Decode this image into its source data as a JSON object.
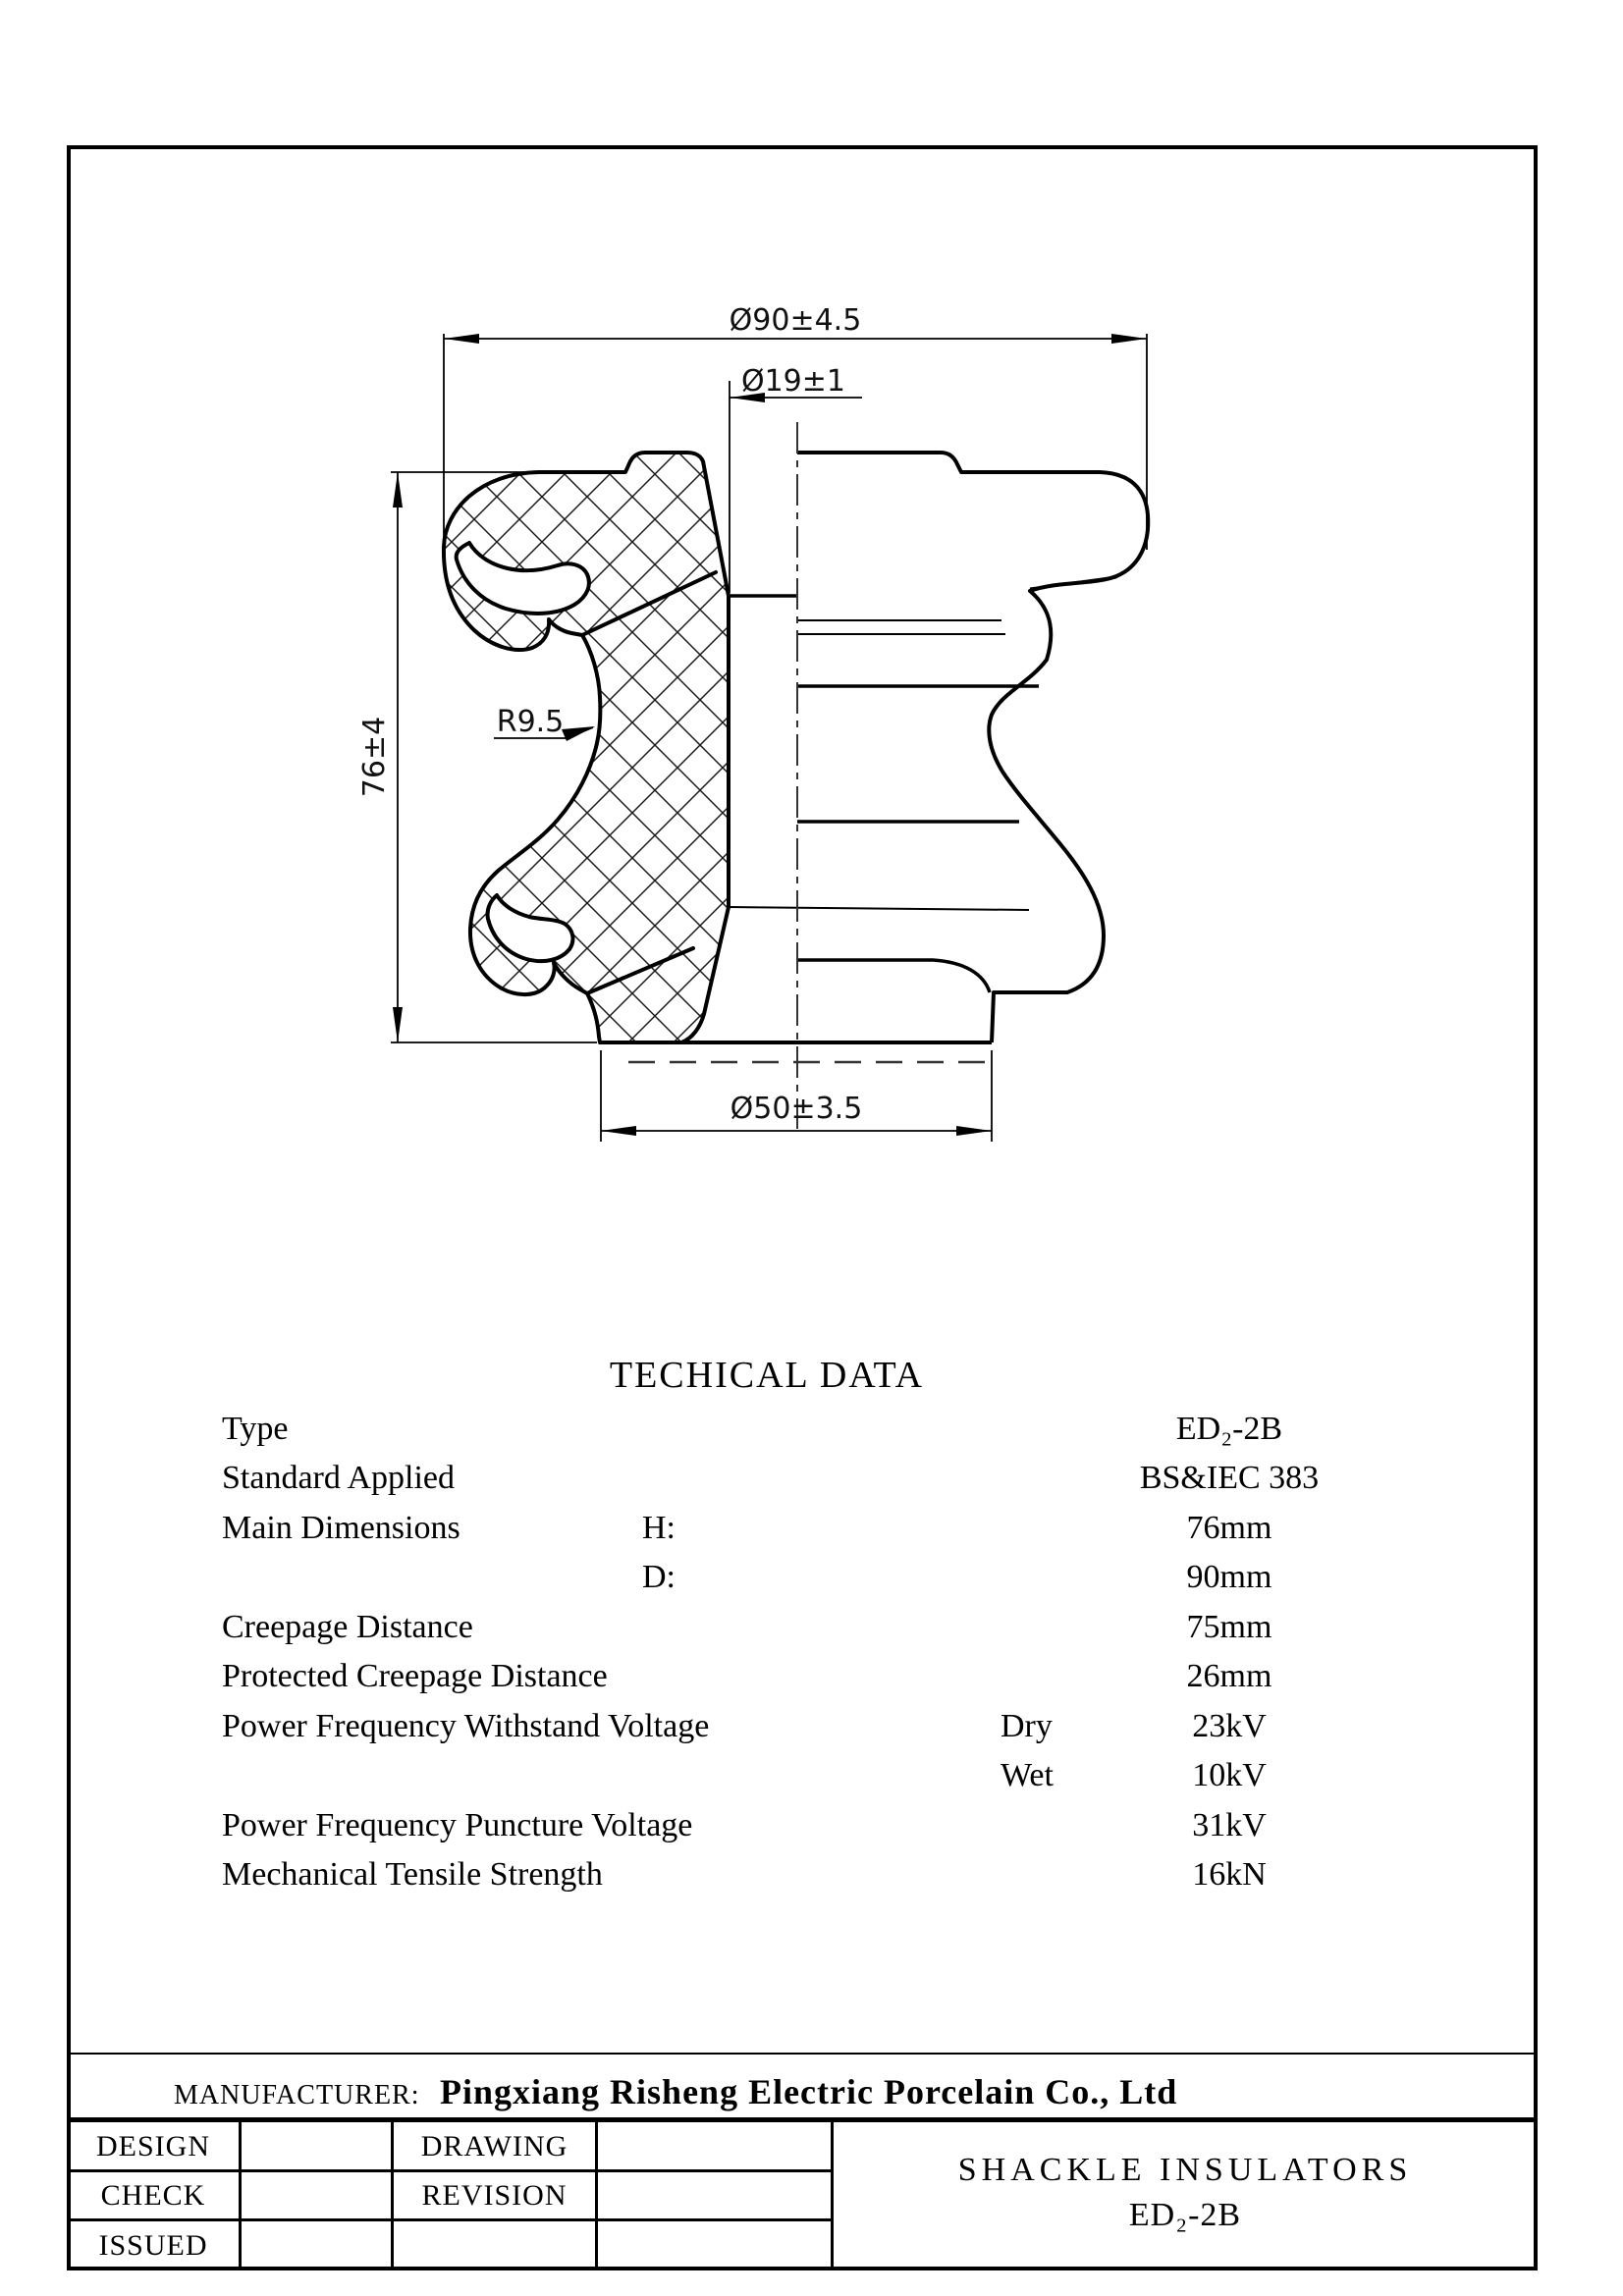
{
  "drawing": {
    "dimensions": {
      "top_diameter": "Ø90±4.5",
      "hole_diameter": "Ø19±1",
      "height": "76±4",
      "groove_radius": "R9.5",
      "base_diameter": "Ø50±3.5"
    }
  },
  "tech_table": {
    "title": "TECHICAL DATA",
    "rows": [
      {
        "label": "Type",
        "sub1": "",
        "sub2": "",
        "value": "ED₂-2B"
      },
      {
        "label": "Standard Applied",
        "sub1": "",
        "sub2": "",
        "value": "BS&IEC 383"
      },
      {
        "label": "Main Dimensions",
        "sub1": "H:",
        "sub2": "",
        "value": "76mm"
      },
      {
        "label": "",
        "sub1": "D:",
        "sub2": "",
        "value": "90mm"
      },
      {
        "label": "Creepage Distance",
        "sub1": "",
        "sub2": "",
        "value": "75mm"
      },
      {
        "label": "Protected Creepage Distance",
        "sub1": "",
        "sub2": "",
        "value": "26mm"
      },
      {
        "label": "Power Frequency Withstand Voltage",
        "sub1": "",
        "sub2": "Dry",
        "value": "23kV"
      },
      {
        "label": "",
        "sub1": "",
        "sub2": "Wet",
        "value": "10kV"
      },
      {
        "label": "Power Frequency Puncture Voltage",
        "sub1": "",
        "sub2": "",
        "value": "31kV"
      },
      {
        "label": "Mechanical Tensile Strength",
        "sub1": "",
        "sub2": "",
        "value": "16kN"
      }
    ]
  },
  "title_block": {
    "manufacturer_label": "MANUFACTURER:",
    "manufacturer_name": "Pingxiang Risheng Electric Porcelain Co., Ltd",
    "design_label": "DESIGN",
    "check_label": "CHECK",
    "issued_label": "ISSUED",
    "drawing_label": "DRAWING",
    "revision_label": "REVISION",
    "product_title": "SHACKLE INSULATORS",
    "product_model": "ED₂-2B"
  }
}
